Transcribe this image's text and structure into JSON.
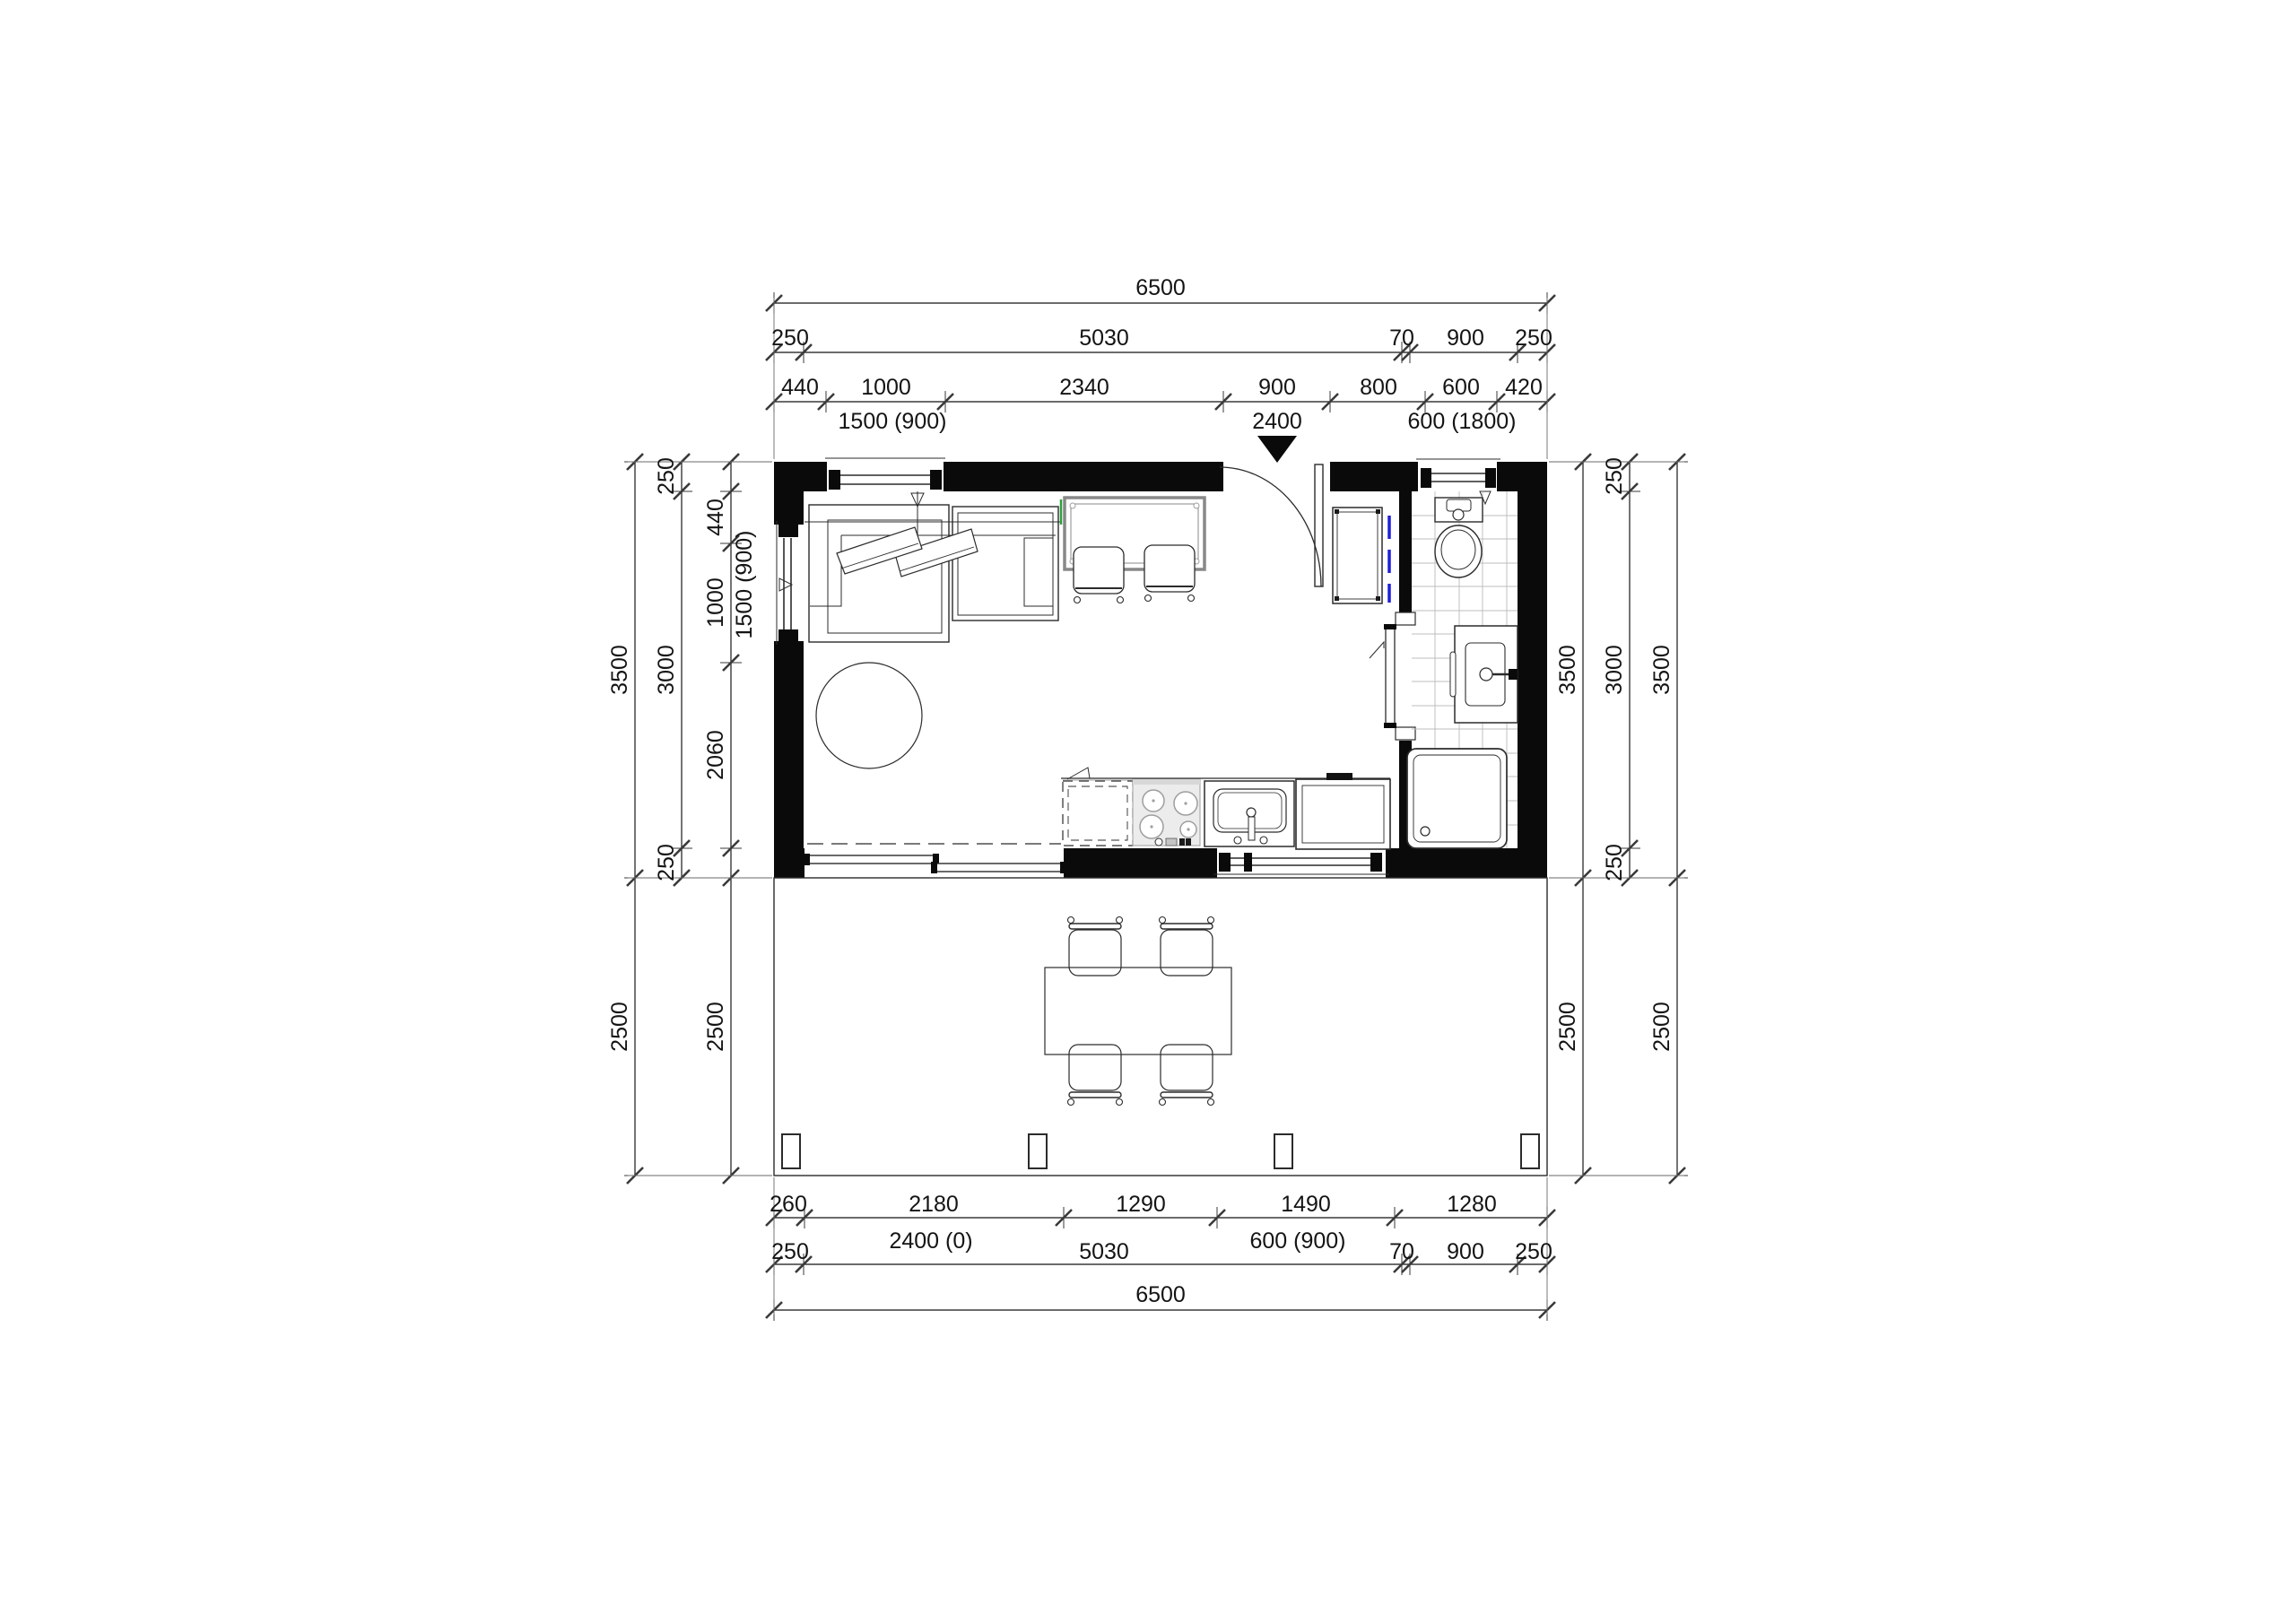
{
  "dims": {
    "top": {
      "total": "6500",
      "chain1": [
        "250",
        "5030",
        "70",
        "900",
        "250"
      ],
      "chain2": [
        "440",
        "1000",
        "2340",
        "900",
        "800",
        "600",
        "420"
      ],
      "openings": [
        "1500 (900)",
        "2400",
        "600 (1800)"
      ]
    },
    "bottom": {
      "chain1": [
        "260",
        "2180",
        "1290",
        "1490",
        "1280"
      ],
      "chain2": [
        "250",
        "5030",
        "70",
        "900",
        "250"
      ],
      "openings": [
        "2400 (0)",
        "600 (900)"
      ],
      "total": "6500"
    },
    "left": {
      "total_line": [
        "3500",
        "2500"
      ],
      "wall_line": [
        "250",
        "3000",
        "250"
      ],
      "detail_line": [
        "440",
        "1000",
        "2060",
        "2500"
      ],
      "window_label": "1500 (900)"
    },
    "right": {
      "inner_line": [
        "3500",
        "2500"
      ],
      "wall_line": [
        "250",
        "3000",
        "250"
      ],
      "outer_line": [
        "3500",
        "2500"
      ]
    }
  },
  "colors": {
    "wall": "#0a0a0a",
    "line": "#2b2b2b",
    "sliding_marker_blue": "#2020d8",
    "reference_green": "#2e9e3e"
  }
}
